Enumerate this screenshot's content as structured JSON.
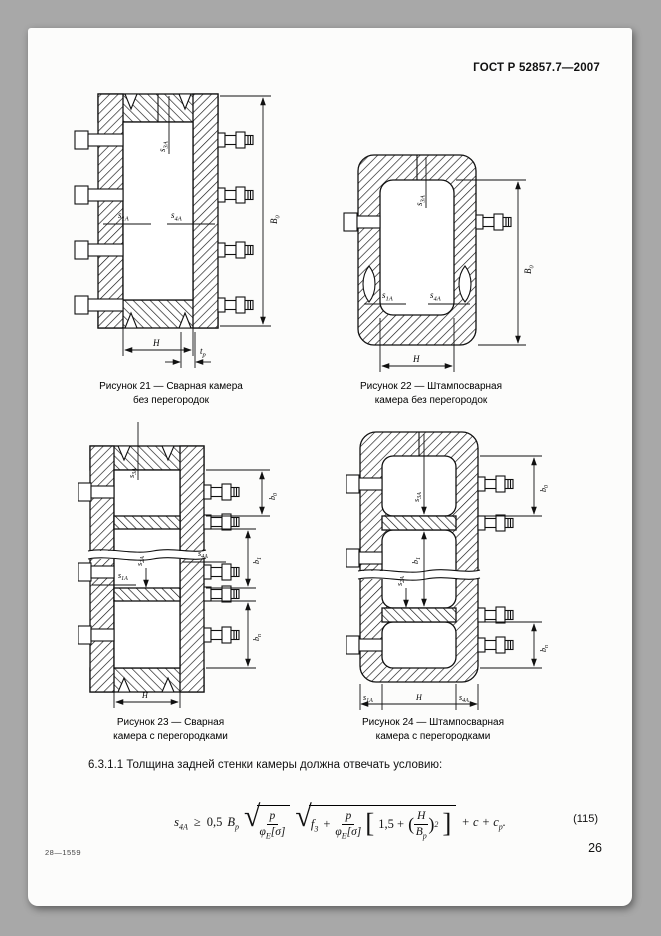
{
  "page": {
    "header": "ГОСТ Р 52857.7—2007",
    "section_text": "6.3.1.1 Толщина задней стенки камеры должна отвечать условию:",
    "footer_code": "28—1559",
    "page_number": "26"
  },
  "figures": [
    {
      "id": "21",
      "caption1": "Рисунок 21 — Сварная камера",
      "caption2": "без перегородок",
      "labels": {
        "s3": {
          "b": "s",
          "s": "3А"
        },
        "s1": {
          "b": "s",
          "s": "1А"
        },
        "s4": {
          "b": "s",
          "s": "4А"
        },
        "B0": {
          "b": "B",
          "s": "0"
        },
        "H": "H",
        "tp": {
          "b": "t",
          "s": "р"
        }
      }
    },
    {
      "id": "22",
      "caption1": "Рисунок 22 — Штампосварная",
      "caption2": "камера без перегородок",
      "labels": {
        "s3": {
          "b": "s",
          "s": "3А"
        },
        "s1": {
          "b": "s",
          "s": "1А"
        },
        "s4": {
          "b": "s",
          "s": "4А"
        },
        "B0": {
          "b": "B",
          "s": "0"
        },
        "H": "H"
      }
    },
    {
      "id": "23",
      "caption1": "Рисунок 23 — Сварная",
      "caption2": "камера с перегородками",
      "labels": {
        "s3": {
          "b": "s",
          "s": "3А"
        },
        "s1": {
          "b": "s",
          "s": "1А"
        },
        "s2": {
          "b": "s",
          "s": "2А"
        },
        "s4": {
          "b": "s",
          "s": "4А"
        },
        "b0": {
          "b": "b",
          "s": "0"
        },
        "b1": {
          "b": "b",
          "s": "1"
        },
        "bn": {
          "b": "b",
          "s": "n"
        },
        "H": "H"
      }
    },
    {
      "id": "24",
      "caption1": "Рисунок 24 — Штампосварная",
      "caption2": "камера с перегородками",
      "labels": {
        "s3": {
          "b": "s",
          "s": "3А"
        },
        "s1": {
          "b": "s",
          "s": "1А"
        },
        "s2": {
          "b": "s",
          "s": "2А"
        },
        "s4": {
          "b": "s",
          "s": "4А"
        },
        "b0": {
          "b": "b",
          "s": "0"
        },
        "b1": {
          "b": "b",
          "s": "1"
        },
        "bn": {
          "b": "b",
          "s": "n"
        },
        "H": "H"
      }
    }
  ],
  "formula": {
    "lhs": {
      "b": "s",
      "s": "4А"
    },
    "rel": "≥",
    "coef": "0,5",
    "B": {
      "b": "B",
      "s": "р"
    },
    "frac1": {
      "num": "p",
      "den_b": "φ",
      "den_s": "Е",
      "den_r": "[σ]"
    },
    "f": {
      "b": "f",
      "s": "3"
    },
    "plus": "+",
    "frac2": {
      "num": "p",
      "den_b": "φ",
      "den_s": "Е",
      "den_r": "[σ]"
    },
    "bracket_lead": "1,5 +",
    "inner": {
      "num": "H",
      "den_b": "B",
      "den_s": "р"
    },
    "power": "2",
    "tail": "+ c + c",
    "tail_sub": "р",
    "end": ".",
    "number": "(115)"
  }
}
